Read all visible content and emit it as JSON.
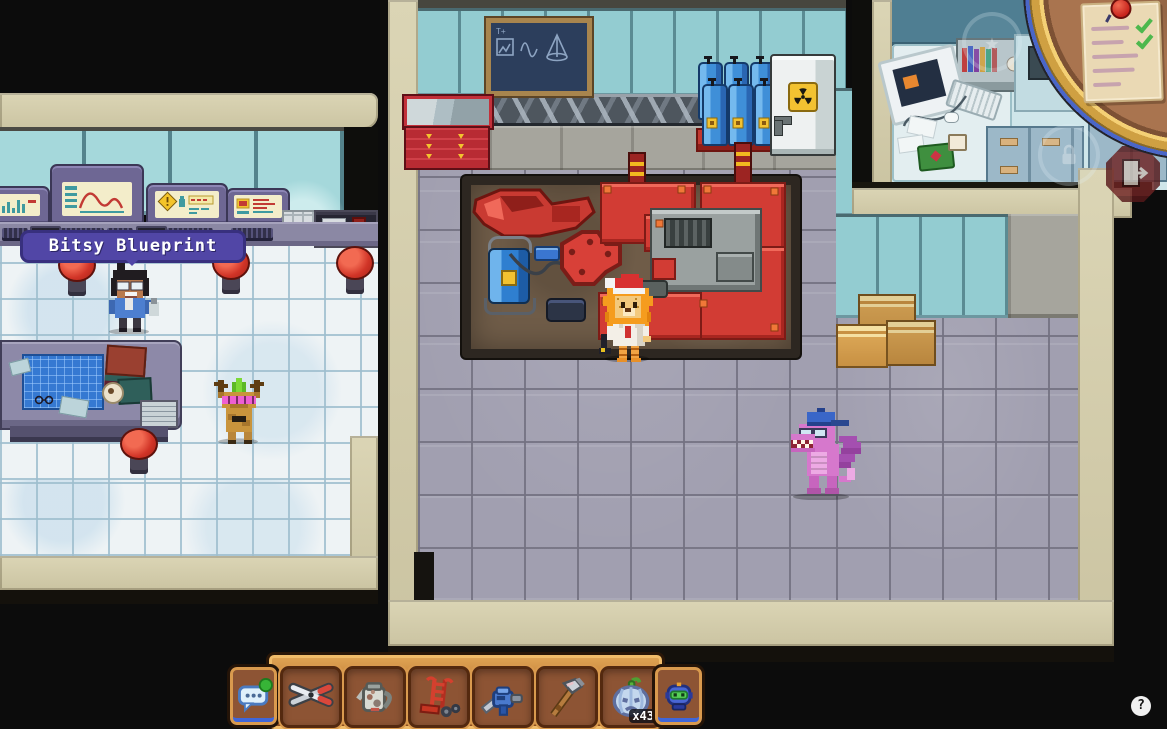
{
  "ui": {
    "tooltip": {
      "text": "Bitsy Blueprint"
    },
    "hotbar": {
      "left_button": {
        "icon": "chat-bubble-icon",
        "notification": "green-dot"
      },
      "right_button": {
        "icon": "robot-companion-icon"
      },
      "slots": [
        {
          "item": "garden-shears"
        },
        {
          "item": "watering-can"
        },
        {
          "item": "hand-truck"
        },
        {
          "item": "mining-drill"
        },
        {
          "item": "axe"
        },
        {
          "item": "frost-pumpkin",
          "count": "x43"
        }
      ]
    },
    "minimap": {
      "quest_scroll": {
        "lines": 5,
        "checked_items": 2,
        "pin": "red-pin"
      }
    },
    "overlay_icons": {
      "exit": "exit-door-icon",
      "faint_star": "star-icon",
      "faint_lock": "lock-icon"
    },
    "help_button": {
      "label": "?"
    }
  },
  "world": {
    "player": "lion-with-santa-hat",
    "npc": "scientist-with-ponytail",
    "pets": [
      "jackalope-with-party-glasses",
      "purple-dragon-with-cap"
    ],
    "rooms": [
      "control-lab",
      "workshop",
      "office"
    ],
    "objects": [
      "chalkboard",
      "gas-canisters",
      "radiation-locker",
      "red-cabinet",
      "workbench-machines",
      "pressure-washer",
      "cardboard-boxes",
      "blueprint-table",
      "stools",
      "wall-consoles"
    ]
  },
  "palette": {
    "background": "#0c0c0c",
    "wall_beige": "#cfc8a6",
    "stone_floor": "#a19fb0",
    "white_tile": "#eef3f5",
    "window_teal": "#a5d8db",
    "machine_red": "#d23c34",
    "canister_blue": "#3f8fd8",
    "tooltip_purple": "#5146a6",
    "hotbar_bronze": "#c98544",
    "quest_check_green": "#4db84d"
  }
}
